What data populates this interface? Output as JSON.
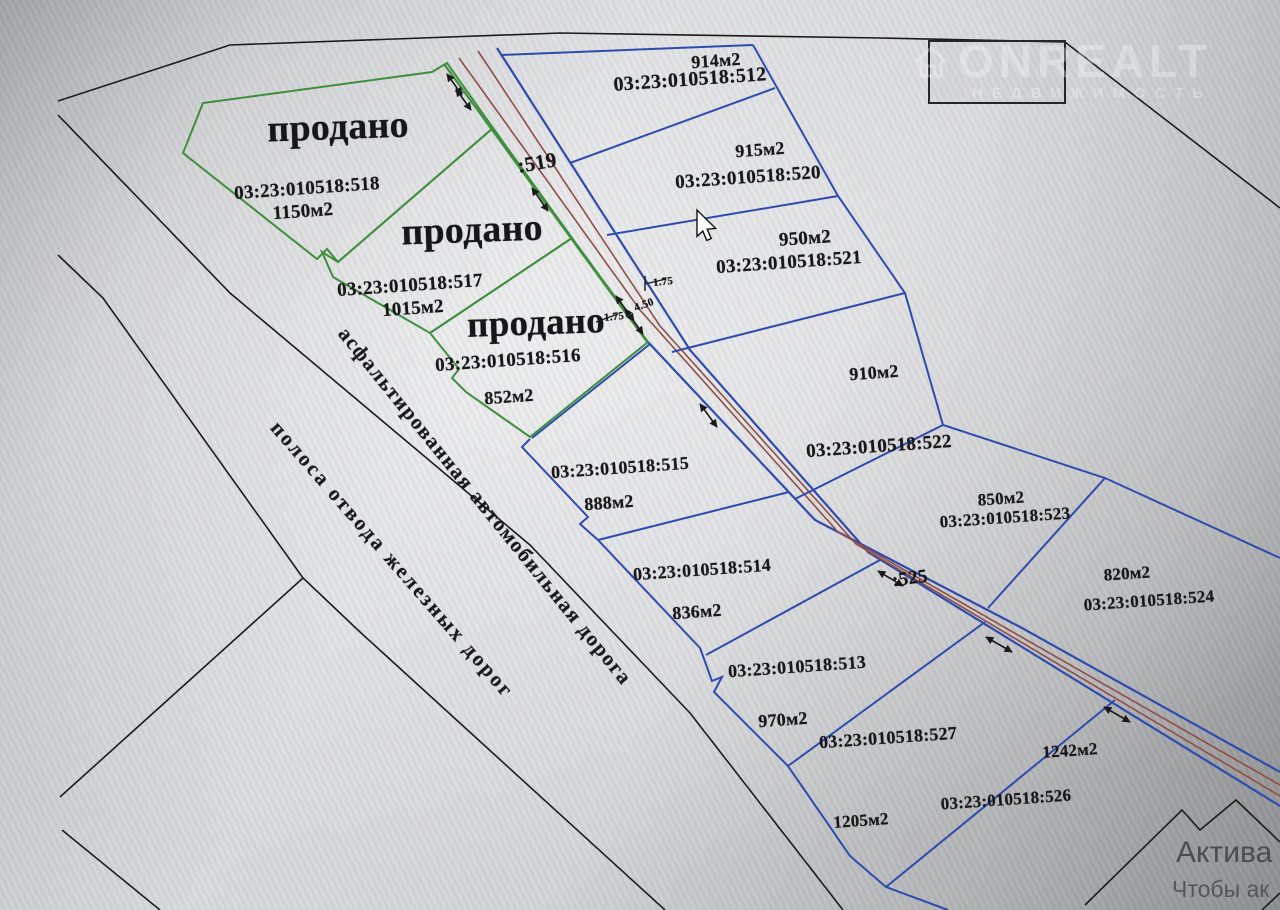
{
  "watermark": {
    "brand": "ONREALT",
    "subtitle": "НЕДВИЖИМОСТЬ"
  },
  "activation": {
    "line1": "Актива",
    "line2": "Чтобы ак"
  },
  "roads": {
    "asphalt_label": "асфальтированная автомобильная дорога",
    "railway_label": "полоса отвода железных дорог",
    "upper_parcel": ":519",
    "lower_parcel": ":525"
  },
  "dimensions": {
    "right": "1.75",
    "middle": "4.50",
    "left": "1.75"
  },
  "plots": [
    {
      "id": "518",
      "cadastral": "03:23:010518:518",
      "area": "1150м2",
      "status": "продано",
      "type": "sold"
    },
    {
      "id": "517",
      "cadastral": "03:23:010518:517",
      "area": "1015м2",
      "status": "продано",
      "type": "sold"
    },
    {
      "id": "516",
      "cadastral": "03:23:010518:516",
      "area": "852м2",
      "status": "продано",
      "type": "sold"
    },
    {
      "id": "512",
      "cadastral": "03:23:010518:512",
      "area": "914м2",
      "type": "available"
    },
    {
      "id": "520",
      "cadastral": "03:23:010518:520",
      "area": "915м2",
      "type": "available"
    },
    {
      "id": "521",
      "cadastral": "03:23:010518:521",
      "area": "950м2",
      "type": "available"
    },
    {
      "id": "522",
      "cadastral": "03:23:010518:522",
      "area": "910м2",
      "type": "available"
    },
    {
      "id": "523",
      "cadastral": "03:23:010518:523",
      "area": "850м2",
      "type": "available"
    },
    {
      "id": "524",
      "cadastral": "03:23:010518:524",
      "area": "820м2",
      "type": "available"
    },
    {
      "id": "515",
      "cadastral": "03:23:010518:515",
      "area": "888м2",
      "type": "available"
    },
    {
      "id": "514",
      "cadastral": "03:23:010518:514",
      "area": "836м2",
      "type": "available"
    },
    {
      "id": "513",
      "cadastral": "03:23:010518:513",
      "area": "970м2",
      "type": "available"
    },
    {
      "id": "527",
      "cadastral": "03:23:010518:527",
      "area": "1205м2",
      "type": "available"
    },
    {
      "id": "526",
      "cadastral": "03:23:010518:526",
      "area": "1242м2",
      "type": "available"
    }
  ],
  "colors": {
    "available_boundary": "#2e4bb0",
    "sold_boundary": "#3f8f3f",
    "road_edge_line": "#8e4f46",
    "outline": "#1c1c1e"
  }
}
